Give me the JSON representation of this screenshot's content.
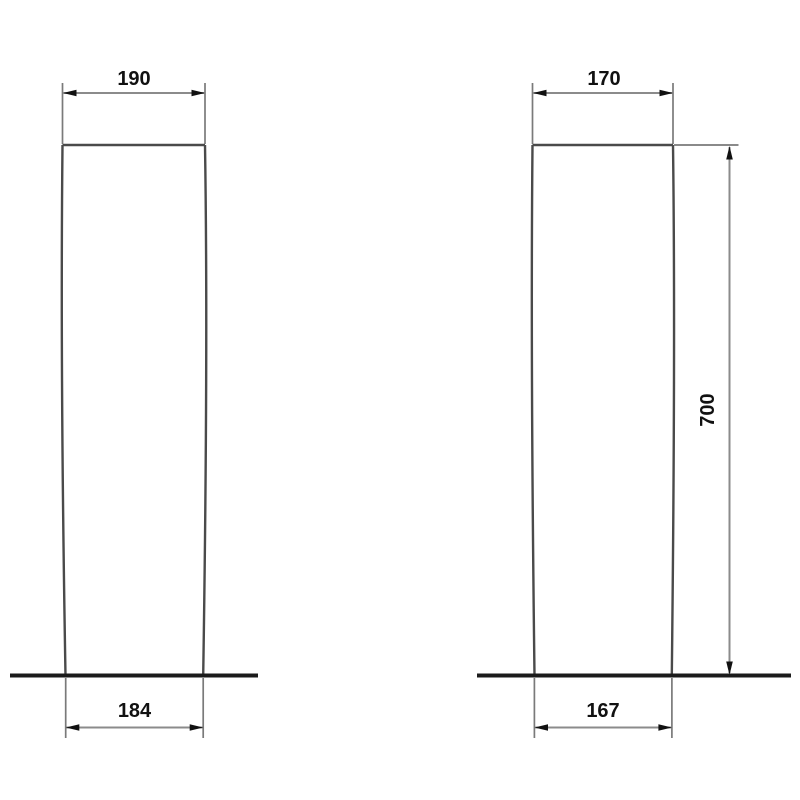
{
  "drawing": {
    "kind": "pedestal-dimension-drawing",
    "left_view": {
      "top_width_label": "190",
      "bottom_width_label": "184"
    },
    "right_view": {
      "top_width_label": "170",
      "bottom_width_label": "167",
      "height_label": "700"
    }
  },
  "colors": {
    "background": "#ffffff",
    "shape_outline": "#4a4a4a",
    "dimension_line": "#8b8b8b",
    "extension_line": "#7a7a7a",
    "arrow_and_text": "#111111",
    "ground_line": "#1b1b1b"
  }
}
